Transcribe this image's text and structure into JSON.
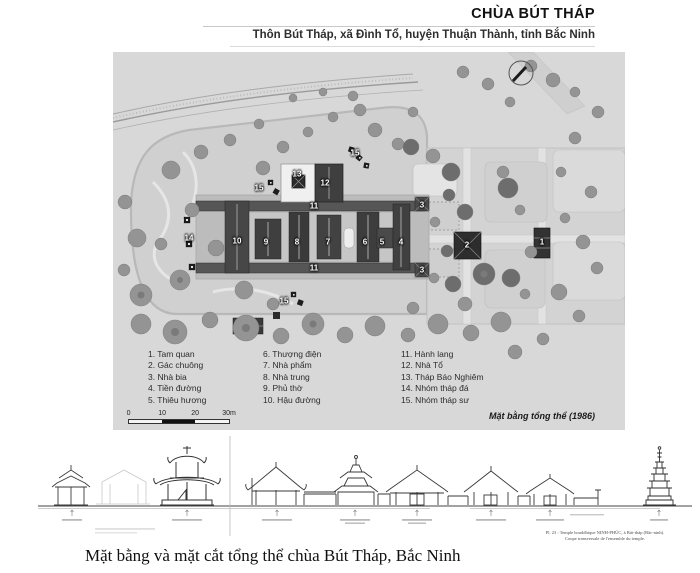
{
  "header": {
    "title": "CHÙA BÚT THÁP",
    "subtitle": "Thôn Bút Tháp, xã Đình Tổ, huyện Thuận Thành, tỉnh Bắc Ninh"
  },
  "plan": {
    "caption": "Mặt bằng tổng thể (1986)",
    "scale": {
      "ticks": [
        "0",
        "10",
        "20",
        "30m"
      ]
    },
    "legend": {
      "columns": [
        [
          {
            "n": "1",
            "label": "Tam quan"
          },
          {
            "n": "2",
            "label": "Gác chuông"
          },
          {
            "n": "3",
            "label": "Nhà bia"
          },
          {
            "n": "4",
            "label": "Tiền đường"
          },
          {
            "n": "5",
            "label": "Thiêu hương"
          }
        ],
        [
          {
            "n": "6",
            "label": "Thượng điện"
          },
          {
            "n": "7",
            "label": "Nhà phẩm"
          },
          {
            "n": "8",
            "label": "Nhà trung"
          },
          {
            "n": "9",
            "label": "Phủ thờ"
          },
          {
            "n": "10",
            "label": "Hậu đường"
          }
        ],
        [
          {
            "n": "11",
            "label": "Hành lang"
          },
          {
            "n": "12",
            "label": "Nhà Tổ"
          },
          {
            "n": "13",
            "label": "Tháp Báo Nghiêm"
          },
          {
            "n": "14",
            "label": "Nhóm tháp đá"
          },
          {
            "n": "15",
            "label": "Nhóm tháp sư"
          }
        ]
      ]
    },
    "markers": [
      {
        "n": "1",
        "x": 429,
        "y": 190
      },
      {
        "n": "2",
        "x": 354,
        "y": 193
      },
      {
        "n": "3",
        "x": 309,
        "y": 153
      },
      {
        "n": "3",
        "x": 309,
        "y": 218
      },
      {
        "n": "4",
        "x": 288,
        "y": 190
      },
      {
        "n": "5",
        "x": 269,
        "y": 190
      },
      {
        "n": "6",
        "x": 252,
        "y": 190
      },
      {
        "n": "7",
        "x": 215,
        "y": 190
      },
      {
        "n": "8",
        "x": 184,
        "y": 190
      },
      {
        "n": "9",
        "x": 153,
        "y": 190
      },
      {
        "n": "10",
        "x": 124,
        "y": 189
      },
      {
        "n": "11",
        "x": 201,
        "y": 154
      },
      {
        "n": "11",
        "x": 201,
        "y": 216
      },
      {
        "n": "12",
        "x": 212,
        "y": 131
      },
      {
        "n": "13",
        "x": 184,
        "y": 122
      },
      {
        "n": "14",
        "x": 76,
        "y": 186
      },
      {
        "n": "15",
        "x": 242,
        "y": 101
      },
      {
        "n": "15",
        "x": 146,
        "y": 136
      },
      {
        "n": "15",
        "x": 171,
        "y": 249
      }
    ]
  },
  "section": {
    "caption_line1": "Pl. 23 : Temple bouddhique NINH-PHÚC, à Bút-tháp (Bắc-ninh).",
    "caption_line2": "Coupe transversale de l'ensemble du temple."
  },
  "footer": {
    "caption": "Mặt bằng và mặt cắt tổng thể chùa Bút Tháp, Bắc Ninh"
  },
  "colors": {
    "plan_background": "#d8d8d8",
    "garden_ground": "#d0d0d0",
    "roof_dark": "#3f3f3f",
    "corridor": "#565656",
    "tree_gray": "#949494",
    "tree_dark": "#6d6d6d",
    "line_ink": "#383838"
  }
}
